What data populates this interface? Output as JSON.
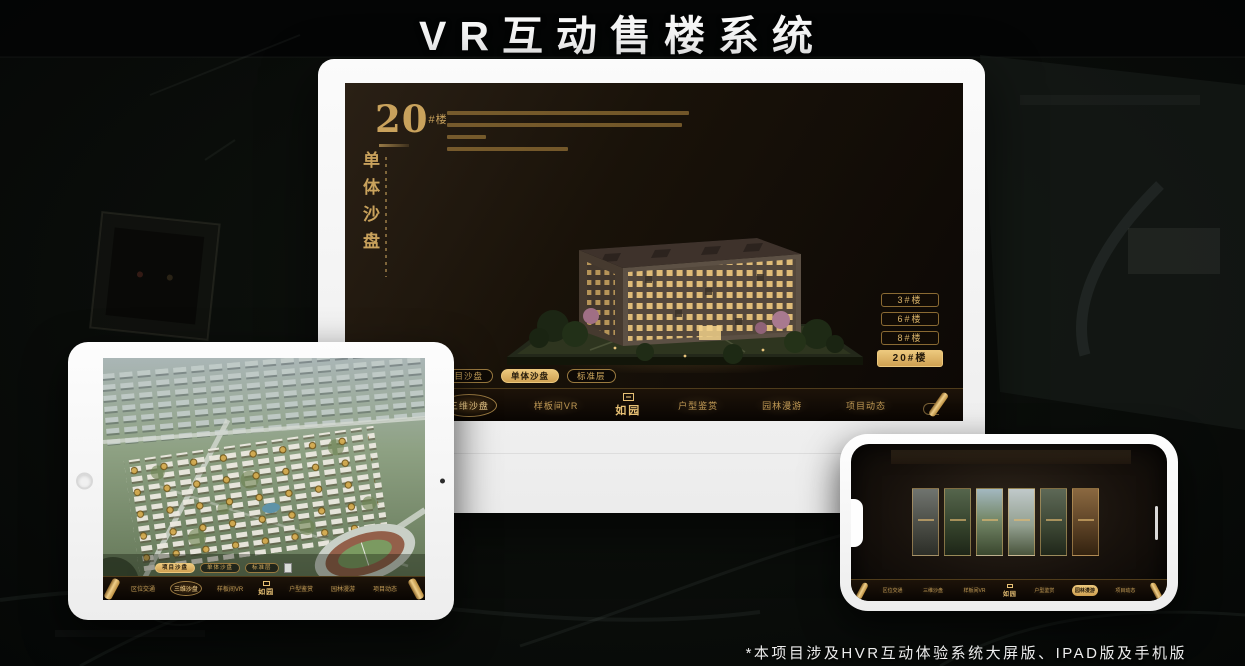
{
  "page": {
    "title": "VR互动售楼系统",
    "footnote": "*本项目涉及HVR互动体验系统大屏版、IPAD版及手机版"
  },
  "colors": {
    "gold": "#c9a25c",
    "gold_bright": "#ecc87d",
    "screen_dark": "#191209",
    "bezel_white": "#fbfbfb"
  },
  "icons": {
    "scroll_handle": "scroll-handle-icon",
    "seal": "seal-icon",
    "home_button": "home-button",
    "camera": "camera-icon"
  },
  "desktop": {
    "headline": {
      "number": "20",
      "unit": "#楼",
      "vertical": "单体沙盘"
    },
    "floor_buttons": [
      {
        "label": "3#楼",
        "active": false
      },
      {
        "label": "6#楼",
        "active": false
      },
      {
        "label": "8#楼",
        "active": false
      },
      {
        "label": "20#楼",
        "active": true
      }
    ],
    "sub_tabs": [
      {
        "label": "项目沙盘",
        "active": false
      },
      {
        "label": "单体沙盘",
        "active": true
      },
      {
        "label": "标准层",
        "active": false
      }
    ],
    "nav": {
      "left": [
        {
          "label": "区位交通",
          "active": false
        },
        {
          "label": "三维沙盘",
          "active": true
        },
        {
          "label": "样板间VR",
          "active": false
        }
      ],
      "logo": "如园",
      "right": [
        {
          "label": "户型鉴赏",
          "active": false
        },
        {
          "label": "园林漫游",
          "active": false
        },
        {
          "label": "项目动态",
          "active": false
        }
      ]
    }
  },
  "tablet": {
    "sub_tabs": [
      {
        "label": "项目沙盘",
        "active": true
      },
      {
        "label": "单体沙盘",
        "active": false
      },
      {
        "label": "标准层",
        "active": false
      }
    ],
    "nav": {
      "left": [
        {
          "label": "区位交通",
          "active": false
        },
        {
          "label": "三维沙盘",
          "active": true
        },
        {
          "label": "样板间VR",
          "active": false
        }
      ],
      "logo": "如园",
      "right": [
        {
          "label": "户型鉴赏",
          "active": false
        },
        {
          "label": "园林漫游",
          "active": false
        },
        {
          "label": "项目动态",
          "active": false
        }
      ]
    }
  },
  "phone": {
    "nav": {
      "left": [
        {
          "label": "区位交通",
          "active": false
        },
        {
          "label": "三维沙盘",
          "active": false
        },
        {
          "label": "样板间VR",
          "active": false
        }
      ],
      "logo": "如园",
      "right": [
        {
          "label": "户型鉴赏",
          "active": false
        },
        {
          "label": "园林漫游",
          "active": true
        },
        {
          "label": "项目动态",
          "active": false
        }
      ]
    }
  }
}
